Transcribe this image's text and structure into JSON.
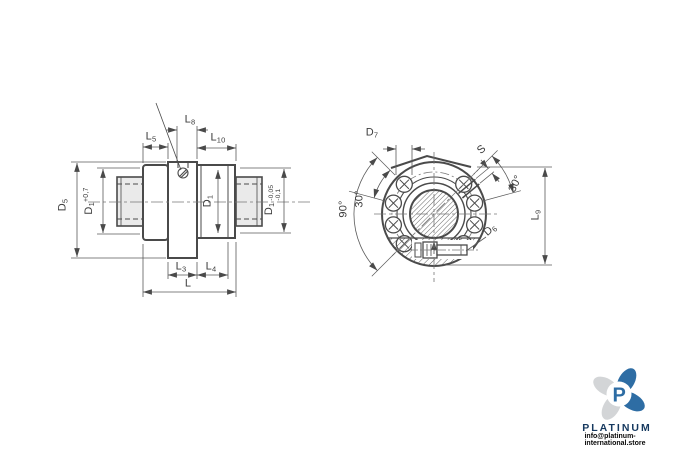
{
  "labels": {
    "d5": {
      "base": "D",
      "sub": "5"
    },
    "d1_plus": {
      "base": "D",
      "sub": "1",
      "tol": "+0,7"
    },
    "l5": {
      "base": "L",
      "sub": "5"
    },
    "l8": {
      "base": "L",
      "sub": "8"
    },
    "l10": {
      "base": "L",
      "sub": "10"
    },
    "d1": {
      "base": "D",
      "sub": "1"
    },
    "d1_minus": {
      "base": "D",
      "sub": "1",
      "tol_top": "-0,05",
      "tol_bottom": "-0,1"
    },
    "l3": {
      "base": "L",
      "sub": "3"
    },
    "l4": {
      "base": "L",
      "sub": "4"
    },
    "l_total": {
      "base": "L"
    },
    "d7": {
      "base": "D",
      "sub": "7"
    },
    "s": {
      "base": "S"
    },
    "angle_right": "30°",
    "angle_left": "30°",
    "angle_90": "90°",
    "l9": {
      "base": "L",
      "sub": "9"
    },
    "d6": {
      "base": "D",
      "sub": "6"
    }
  },
  "branding": {
    "name": "PLATINUM",
    "email": "info@platinum-international.store",
    "brand_blue": "#2e6da4",
    "brand_navy": "#16395f",
    "petal_gray": "#d3d5d7"
  }
}
